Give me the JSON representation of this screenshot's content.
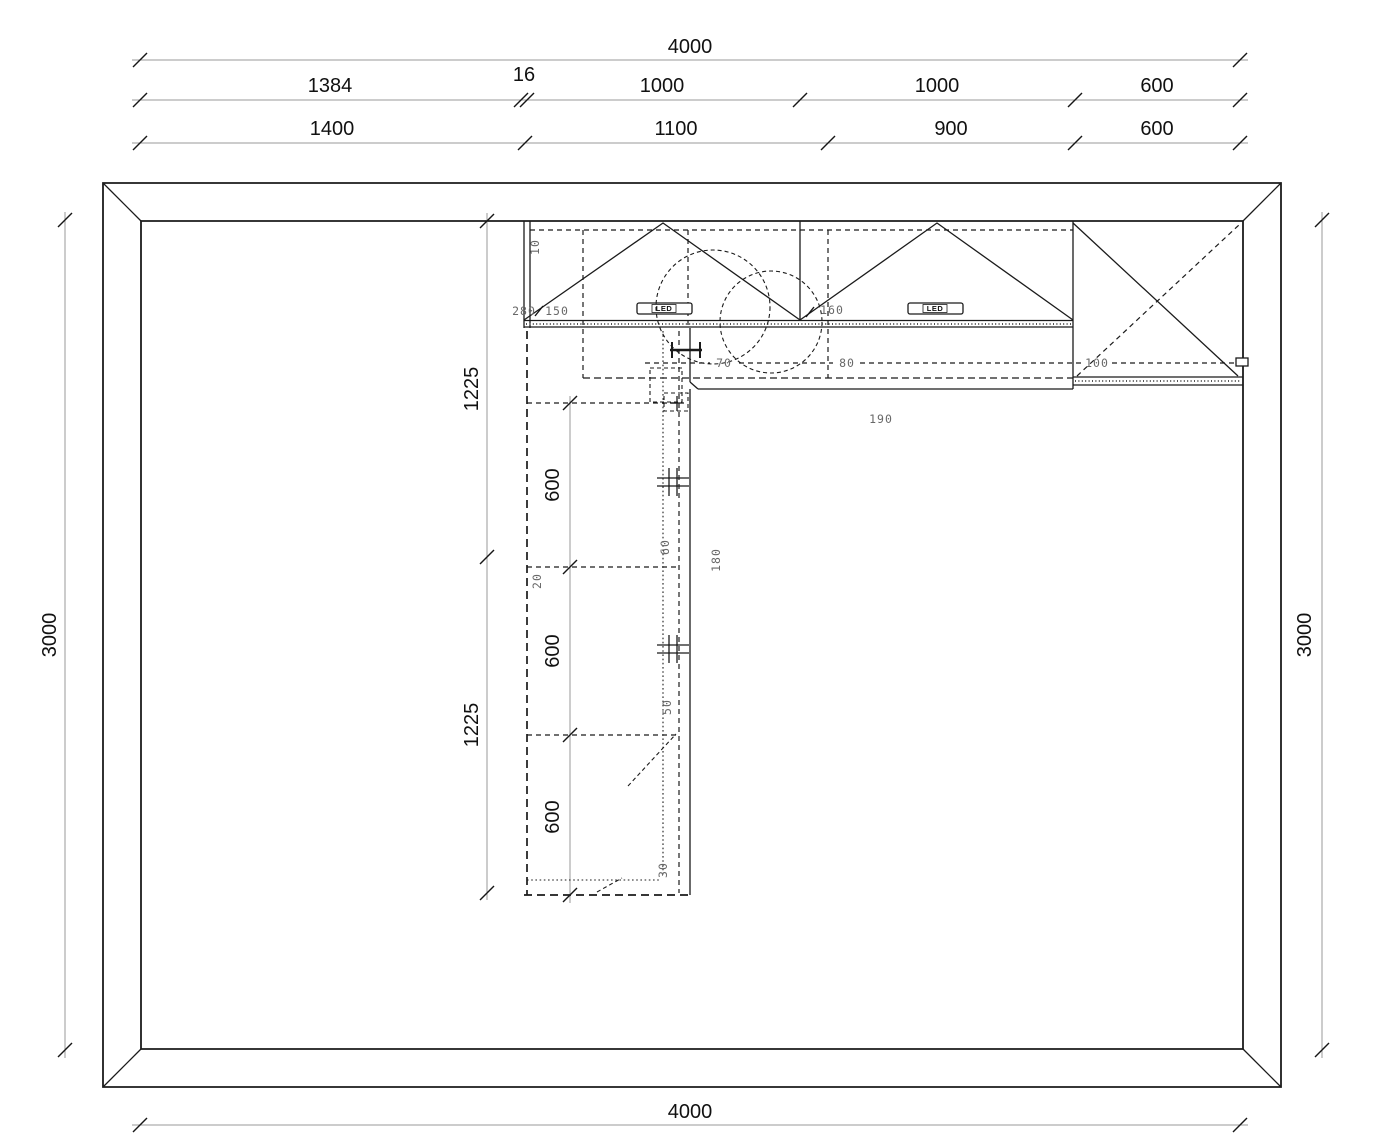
{
  "drawing": {
    "type": "kitchen-floor-plan",
    "colors": {
      "line": "#1b1b1b",
      "dim_line": "#9a9a9a",
      "small_label": "#686868",
      "background": "#ffffff"
    },
    "labels": {
      "led_strip": "LED"
    },
    "dims": {
      "top_total": {
        "value": "4000"
      },
      "top_chain_a": {
        "segments": [
          "1384",
          "16",
          "1000",
          "1000",
          "600"
        ]
      },
      "top_chain_b": {
        "segments": [
          "1400",
          "1100",
          "900",
          "600"
        ]
      },
      "bottom_total": {
        "value": "4000"
      },
      "left_total": {
        "value": "3000"
      },
      "right_total": {
        "value": "3000"
      },
      "inner_left": {
        "segments": [
          "1225",
          "1225"
        ]
      },
      "cabinet_run": {
        "segments": [
          "600",
          "600",
          "600"
        ],
        "gap": "20"
      },
      "details": {
        "wall_gap": "10",
        "corner_a": "280",
        "corner_b": "150",
        "niche": "160",
        "offset_70": "70",
        "offset_80": "80",
        "offset_100": "100",
        "offset_190": "190",
        "offset_180": "180",
        "offset_60": "60",
        "offset_50": "50",
        "offset_30": "30"
      }
    }
  }
}
